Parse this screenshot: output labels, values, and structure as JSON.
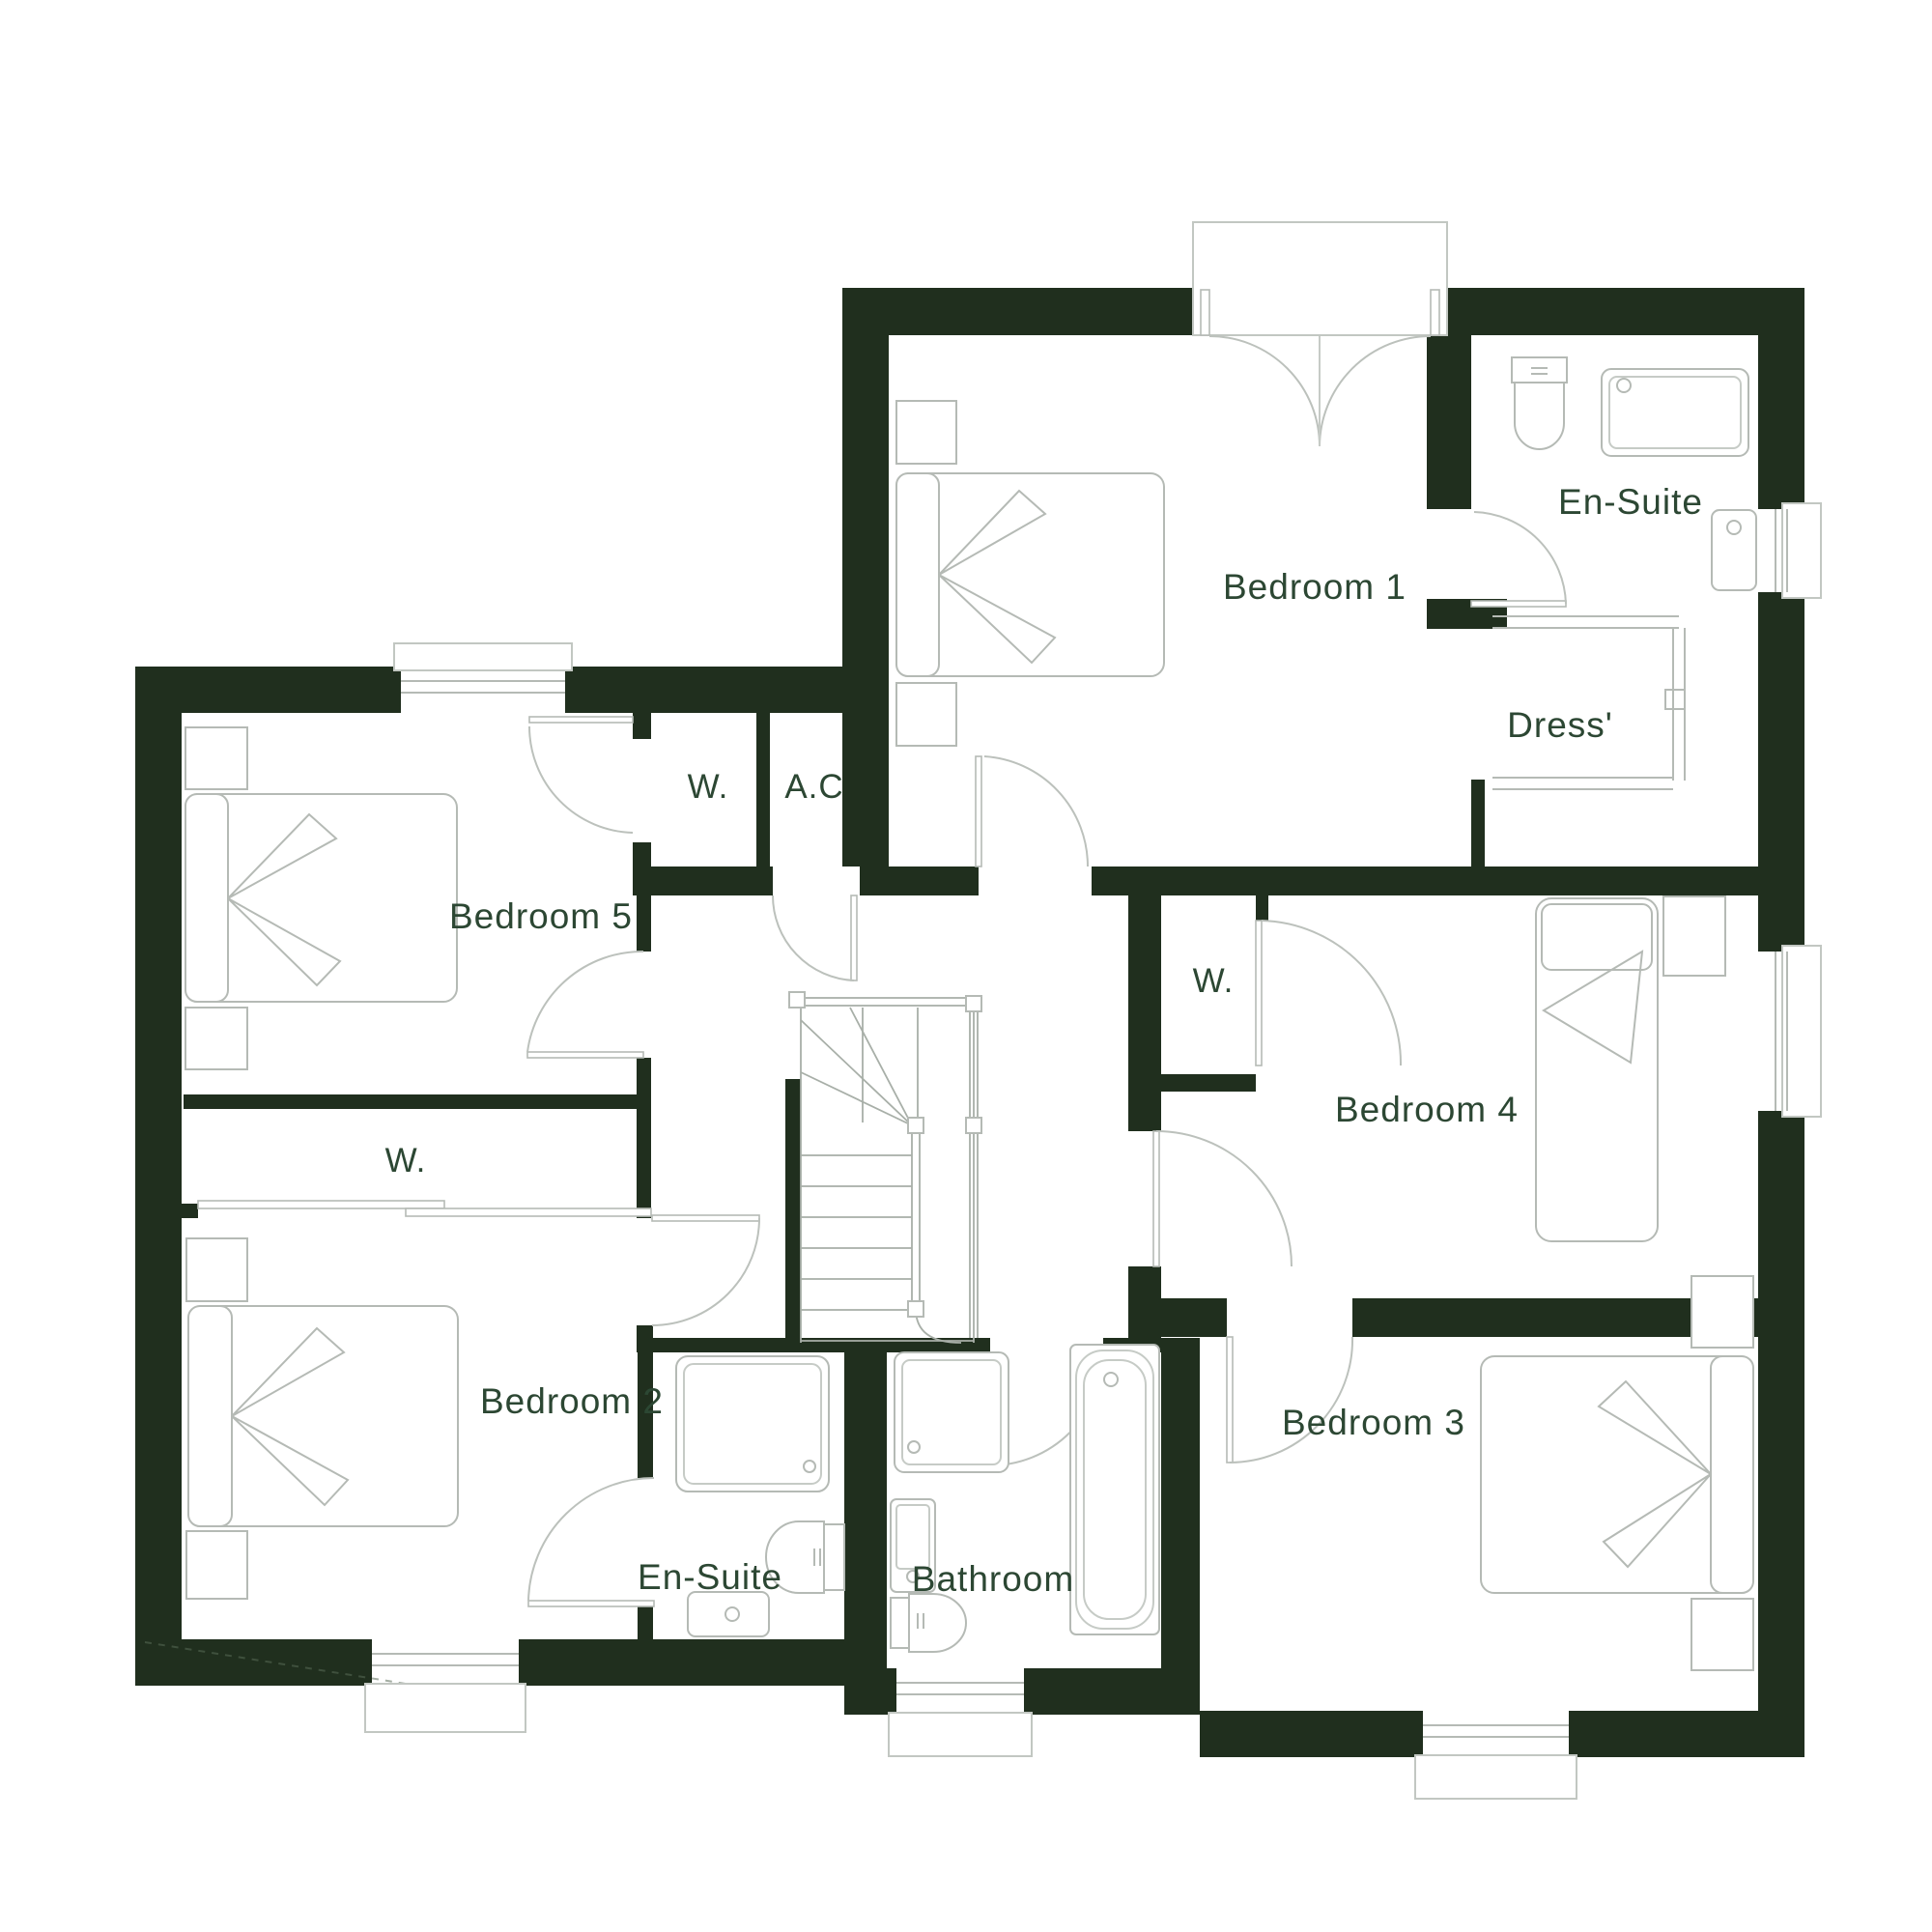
{
  "plan": {
    "type": "residential-floor-plan",
    "floor": "first-floor",
    "colors": {
      "background": "#ffffff",
      "wall": "#202f1e",
      "fixture_line": "#b5bab5",
      "label_text": "#2c4733"
    },
    "rooms": [
      {
        "key": "bedroom-1",
        "label": "Bedroom 1",
        "fixtures": [
          "double-bed",
          "two-nightstands"
        ]
      },
      {
        "key": "ensuite-1",
        "label": "En-Suite",
        "fixtures": [
          "toilet",
          "shower",
          "basin",
          "window"
        ]
      },
      {
        "key": "dressing-room",
        "label": "Dress'",
        "fixtures": [
          "wardrobe-shelving"
        ]
      },
      {
        "key": "closet-bedroom5",
        "label": "W.",
        "fixtures": []
      },
      {
        "key": "airing-cupboard",
        "label": "A.C",
        "fixtures": []
      },
      {
        "key": "bedroom-5",
        "label": "Bedroom 5",
        "fixtures": [
          "double-bed",
          "two-nightstands",
          "window"
        ]
      },
      {
        "key": "closet-bedroom2",
        "label": "W.",
        "fixtures": [
          "sliding-doors"
        ]
      },
      {
        "key": "closet-bedroom4",
        "label": "W.",
        "fixtures": []
      },
      {
        "key": "bedroom-4",
        "label": "Bedroom 4",
        "fixtures": [
          "single-bed",
          "side-table",
          "window"
        ]
      },
      {
        "key": "bedroom-2",
        "label": "Bedroom 2",
        "fixtures": [
          "double-bed",
          "two-nightstands",
          "window"
        ]
      },
      {
        "key": "ensuite-2",
        "label": "En-Suite",
        "fixtures": [
          "shower",
          "toilet",
          "basin"
        ]
      },
      {
        "key": "bathroom",
        "label": "Bathroom",
        "fixtures": [
          "shower",
          "basin",
          "toilet",
          "bathtub",
          "window"
        ]
      },
      {
        "key": "bedroom-3",
        "label": "Bedroom 3",
        "fixtures": [
          "double-bed",
          "two-nightstands",
          "window"
        ]
      }
    ],
    "counts": {
      "bedrooms": 5,
      "ensuites": 2,
      "bathrooms": 1,
      "wardrobes": 3,
      "airing_cupboards": 1,
      "windows": 6,
      "staircases": 1,
      "double_entry_doors": 1
    }
  }
}
